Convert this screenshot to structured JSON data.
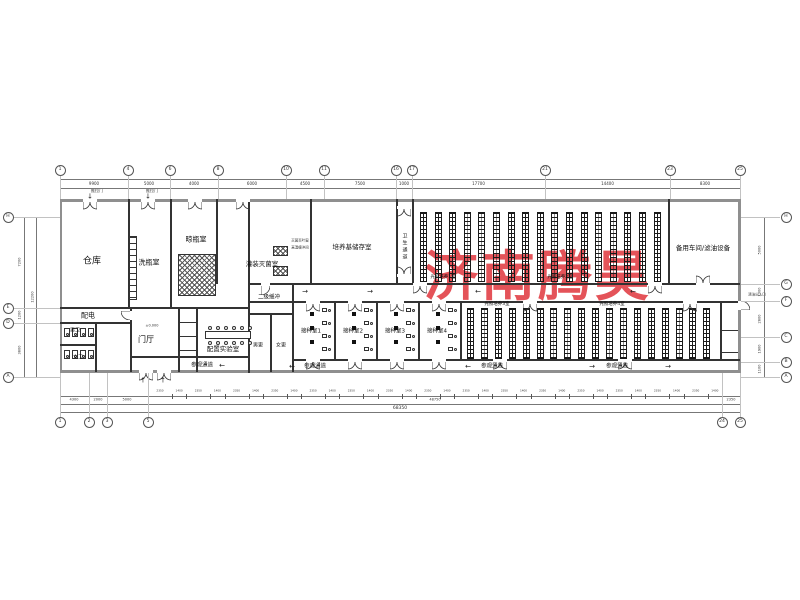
{
  "watermark": {
    "text": "济南腾昊",
    "color": "#e2454b"
  },
  "rooms": [
    {
      "t": "仓库",
      "x": 92,
      "y": 262,
      "fs": 9
    },
    {
      "t": "洗瓶室",
      "x": 149,
      "y": 263,
      "fs": 7
    },
    {
      "t": "晾瓶室",
      "x": 196,
      "y": 240,
      "fs": 7
    },
    {
      "t": "灌装灭菌室",
      "x": 262,
      "y": 264,
      "fs": 6.5
    },
    {
      "t": "培养基储存室",
      "x": 352,
      "y": 247,
      "fs": 6.5
    },
    {
      "t": "卫生通道",
      "x": 404,
      "y": 247,
      "fs": 5,
      "vert": true
    },
    {
      "t": "光照培养1室",
      "x": 443,
      "y": 278,
      "fs": 4.5
    },
    {
      "t": "光照培养2室",
      "x": 560,
      "y": 278,
      "fs": 4.5
    },
    {
      "t": "备用车间/滤油设备",
      "x": 703,
      "y": 248,
      "fs": 6.5
    },
    {
      "t": "二级缓冲",
      "x": 269,
      "y": 298,
      "fs": 5.5
    },
    {
      "t": "配电",
      "x": 88,
      "y": 316,
      "fs": 7
    },
    {
      "t": "男卫",
      "x": 75,
      "y": 331,
      "fs": 5
    },
    {
      "t": "女卫",
      "x": 78,
      "y": 358,
      "fs": 5
    },
    {
      "t": "门厅",
      "x": 146,
      "y": 340,
      "fs": 8
    },
    {
      "t": "配置实验室",
      "x": 223,
      "y": 349,
      "fs": 6.5
    },
    {
      "t": "男更",
      "x": 258,
      "y": 346,
      "fs": 5
    },
    {
      "t": "女更",
      "x": 281,
      "y": 346,
      "fs": 5
    },
    {
      "t": "接种室1",
      "x": 311,
      "y": 332,
      "fs": 5.5
    },
    {
      "t": "接种室2",
      "x": 353,
      "y": 332,
      "fs": 5.5
    },
    {
      "t": "接种室3",
      "x": 395,
      "y": 332,
      "fs": 5.5
    },
    {
      "t": "接种室4",
      "x": 437,
      "y": 332,
      "fs": 5.5
    },
    {
      "t": "光照培养3室",
      "x": 497,
      "y": 305,
      "fs": 4.5
    },
    {
      "t": "光照培养4室",
      "x": 612,
      "y": 305,
      "fs": 4.5
    },
    {
      "t": "参观通道",
      "x": 202,
      "y": 366,
      "fs": 5.5
    },
    {
      "t": "参观通道",
      "x": 315,
      "y": 367,
      "fs": 5.5
    },
    {
      "t": "参观通道",
      "x": 492,
      "y": 367,
      "fs": 5.5
    },
    {
      "t": "参观通道",
      "x": 617,
      "y": 367,
      "fs": 5.5
    }
  ],
  "annotations": [
    {
      "t": "推拉门",
      "x": 97,
      "y": 191,
      "fs": 4
    },
    {
      "t": "推拉门",
      "x": 152,
      "y": 191,
      "fs": 4
    },
    {
      "t": "灭菌百叶窗",
      "x": 300,
      "y": 241,
      "fs": 3.5
    },
    {
      "t": "高温缓冲间",
      "x": 300,
      "y": 248,
      "fs": 3.5
    },
    {
      "t": "清洁出入口",
      "x": 757,
      "y": 295,
      "fs": 3.5
    },
    {
      "t": "±0.000",
      "x": 152,
      "y": 326,
      "fs": 3.5
    }
  ],
  "arrows": [
    {
      "t": "→",
      "x": 305,
      "y": 292
    },
    {
      "t": "→",
      "x": 370,
      "y": 292
    },
    {
      "t": "←",
      "x": 478,
      "y": 292
    },
    {
      "t": "←",
      "x": 633,
      "y": 292
    },
    {
      "t": "←",
      "x": 222,
      "y": 366
    },
    {
      "t": "←",
      "x": 292,
      "y": 367
    },
    {
      "t": "←",
      "x": 468,
      "y": 367
    },
    {
      "t": "→",
      "x": 592,
      "y": 367
    },
    {
      "t": "→",
      "x": 668,
      "y": 367
    },
    {
      "t": "↓",
      "x": 90,
      "y": 197
    },
    {
      "t": "↓",
      "x": 148,
      "y": 197
    },
    {
      "t": "↑",
      "x": 143,
      "y": 381
    },
    {
      "t": "↑",
      "x": 163,
      "y": 381
    }
  ],
  "axes": {
    "top": {
      "bubbles": [
        {
          "t": "1",
          "x": 60
        },
        {
          "t": "4",
          "x": 128
        },
        {
          "t": "6",
          "x": 170
        },
        {
          "t": "8",
          "x": 218
        },
        {
          "t": "10",
          "x": 286
        },
        {
          "t": "11",
          "x": 324
        },
        {
          "t": "16",
          "x": 396
        },
        {
          "t": "17",
          "x": 412
        },
        {
          "t": "21",
          "x": 545
        },
        {
          "t": "23",
          "x": 670
        },
        {
          "t": "25",
          "x": 740
        }
      ],
      "dims": [
        "9900",
        "5000",
        "4000",
        "6000",
        "4500",
        "7500",
        "1000",
        "17700",
        "14400",
        "8300"
      ]
    },
    "bottom": {
      "bubbles": [
        {
          "t": "1",
          "x": 60
        },
        {
          "t": "2",
          "x": 89
        },
        {
          "t": "3",
          "x": 107
        },
        {
          "t": "5",
          "x": 148
        },
        {
          "t": "24",
          "x": 722
        },
        {
          "t": "25",
          "x": 740
        }
      ],
      "small_dims": [
        "2350",
        "1400",
        "2350",
        "1400",
        "2350",
        "1400",
        "2350",
        "1400",
        "2350",
        "1400",
        "2350",
        "1400",
        "2350",
        "1400",
        "2350",
        "1400",
        "2350",
        "1400",
        "2350",
        "1400",
        "2350",
        "1400",
        "2350",
        "1400",
        "2350",
        "1400",
        "2350",
        "1400",
        "2350",
        "1400"
      ],
      "small_span": [
        148,
        722
      ],
      "lineb": [
        {
          "t": "4300",
          "x": 74
        },
        {
          "t": "2000",
          "x": 98
        },
        {
          "t": "5000",
          "x": 127
        },
        {
          "t": "48750",
          "x": 435
        },
        {
          "t": "2350",
          "x": 731
        }
      ],
      "overall": {
        "t": "68350",
        "x": 400
      }
    },
    "left": {
      "bubbles": [
        {
          "t": "H",
          "y": 217
        },
        {
          "t": "E",
          "y": 308
        },
        {
          "t": "D",
          "y": 323
        },
        {
          "t": "A",
          "y": 377
        }
      ],
      "dims": [
        {
          "t": "7200",
          "y": 262
        },
        {
          "t": "1200",
          "y": 315
        },
        {
          "t": "3800",
          "y": 350
        }
      ],
      "overall": {
        "t": "12200",
        "y": 297
      }
    },
    "right": {
      "bubbles": [
        {
          "t": "H",
          "y": 217
        },
        {
          "t": "G",
          "y": 284
        },
        {
          "t": "F",
          "y": 301
        },
        {
          "t": "C",
          "y": 337
        },
        {
          "t": "B",
          "y": 362
        },
        {
          "t": "A",
          "y": 377
        }
      ],
      "dims": [
        {
          "t": "5000",
          "y": 250
        },
        {
          "t": "1300",
          "y": 292
        },
        {
          "t": "2800",
          "y": 319
        },
        {
          "t": "1900",
          "y": 349
        },
        {
          "t": "1100",
          "y": 369
        }
      ]
    }
  },
  "plan": {
    "walls": [
      [
        60,
        199,
        681,
        3,
        1
      ],
      [
        60,
        370,
        681,
        3,
        1
      ],
      [
        60,
        199,
        2,
        174,
        1
      ],
      [
        738,
        199,
        3,
        174,
        1
      ],
      [
        248,
        283,
        492,
        2,
        0
      ],
      [
        248,
        301,
        492,
        2,
        0
      ],
      [
        60,
        307,
        190,
        2,
        0
      ],
      [
        128,
        199,
        2,
        110,
        0
      ],
      [
        170,
        199,
        2,
        110,
        0
      ],
      [
        216,
        199,
        2,
        85,
        0
      ],
      [
        248,
        199,
        2,
        174,
        0
      ],
      [
        310,
        199,
        2,
        85,
        0
      ],
      [
        396,
        199,
        2,
        85,
        0
      ],
      [
        412,
        199,
        2,
        85,
        0
      ],
      [
        668,
        199,
        2,
        85,
        0
      ],
      [
        292,
        283,
        2,
        89,
        0
      ],
      [
        270,
        313,
        2,
        59,
        0
      ],
      [
        248,
        313,
        44,
        2,
        0
      ],
      [
        60,
        322,
        70,
        2,
        0
      ],
      [
        95,
        322,
        2,
        50,
        0
      ],
      [
        60,
        344,
        37,
        2,
        0
      ],
      [
        130,
        307,
        2,
        65,
        0
      ],
      [
        178,
        307,
        2,
        65,
        0
      ],
      [
        196,
        307,
        2,
        65,
        0
      ],
      [
        178,
        322,
        18,
        1,
        0
      ],
      [
        178,
        336,
        18,
        1,
        0
      ],
      [
        178,
        350,
        18,
        1,
        0
      ],
      [
        130,
        356,
        118,
        2,
        0
      ],
      [
        292,
        359,
        448,
        2,
        0
      ],
      [
        334,
        301,
        2,
        59,
        0
      ],
      [
        376,
        301,
        2,
        59,
        0
      ],
      [
        418,
        301,
        2,
        59,
        0
      ],
      [
        460,
        301,
        2,
        59,
        0
      ],
      [
        720,
        301,
        2,
        59,
        0
      ],
      [
        720,
        330,
        18,
        1,
        0
      ],
      [
        720,
        352,
        18,
        1,
        0
      ]
    ],
    "racks": [
      {
        "x0": 420,
        "step": 14.6,
        "n": 17,
        "y": 212,
        "w": 7,
        "h": 70
      },
      {
        "x0": 467,
        "step": 13.9,
        "n": 18,
        "y": 308,
        "w": 7,
        "h": 51
      }
    ],
    "hatches": [
      [
        178,
        254,
        38,
        42
      ],
      [
        273,
        246,
        15,
        10
      ],
      [
        273,
        266,
        15,
        10
      ]
    ],
    "ladder": [
      128,
      236,
      9,
      64
    ],
    "doors": [
      {
        "x": 90,
        "y": 199,
        "t": "d",
        "dir": "down"
      },
      {
        "x": 148,
        "y": 199,
        "t": "d",
        "dir": "down"
      },
      {
        "x": 195,
        "y": 199,
        "t": "d",
        "dir": "down"
      },
      {
        "x": 243,
        "y": 199,
        "t": "d",
        "dir": "down"
      },
      {
        "x": 404,
        "y": 206,
        "t": "d",
        "dir": "down"
      },
      {
        "x": 404,
        "y": 274,
        "t": "d",
        "dir": "up"
      },
      {
        "x": 265,
        "y": 283,
        "t": "s",
        "dir": "down"
      },
      {
        "x": 420,
        "y": 283,
        "t": "d",
        "dir": "down"
      },
      {
        "x": 655,
        "y": 283,
        "t": "d",
        "dir": "down"
      },
      {
        "x": 703,
        "y": 283,
        "t": "d",
        "dir": "up"
      },
      {
        "x": 313,
        "y": 301,
        "t": "d",
        "dir": "down"
      },
      {
        "x": 355,
        "y": 301,
        "t": "d",
        "dir": "down"
      },
      {
        "x": 397,
        "y": 301,
        "t": "d",
        "dir": "down"
      },
      {
        "x": 439,
        "y": 301,
        "t": "d",
        "dir": "down"
      },
      {
        "x": 530,
        "y": 301,
        "t": "d",
        "dir": "down"
      },
      {
        "x": 690,
        "y": 301,
        "t": "d",
        "dir": "down"
      },
      {
        "x": 313,
        "y": 359,
        "t": "d",
        "dir": "down"
      },
      {
        "x": 355,
        "y": 359,
        "t": "d",
        "dir": "down"
      },
      {
        "x": 397,
        "y": 359,
        "t": "d",
        "dir": "down"
      },
      {
        "x": 439,
        "y": 359,
        "t": "d",
        "dir": "down"
      },
      {
        "x": 500,
        "y": 359,
        "t": "d",
        "dir": "down"
      },
      {
        "x": 625,
        "y": 359,
        "t": "d",
        "dir": "down"
      },
      {
        "x": 146,
        "y": 370,
        "t": "d",
        "dir": "down"
      },
      {
        "x": 164,
        "y": 370,
        "t": "d",
        "dir": "down"
      },
      {
        "x": 130,
        "y": 315,
        "t": "s",
        "dir": "left"
      },
      {
        "x": 738,
        "y": 305,
        "t": "s",
        "dir": "right"
      }
    ],
    "toilet_fixtures": [
      [
        64,
        328
      ],
      [
        72,
        328
      ],
      [
        80,
        328
      ],
      [
        88,
        328
      ],
      [
        64,
        350
      ],
      [
        72,
        350
      ],
      [
        80,
        350
      ],
      [
        88,
        350
      ]
    ],
    "lab": {
      "bench": [
        205,
        331,
        46,
        8
      ],
      "stool_xs": [
        208,
        216,
        224,
        232,
        240,
        248
      ],
      "stool_ys": [
        326,
        341
      ]
    },
    "inoc_rooms_x": [
      292,
      334,
      376,
      418
    ]
  }
}
